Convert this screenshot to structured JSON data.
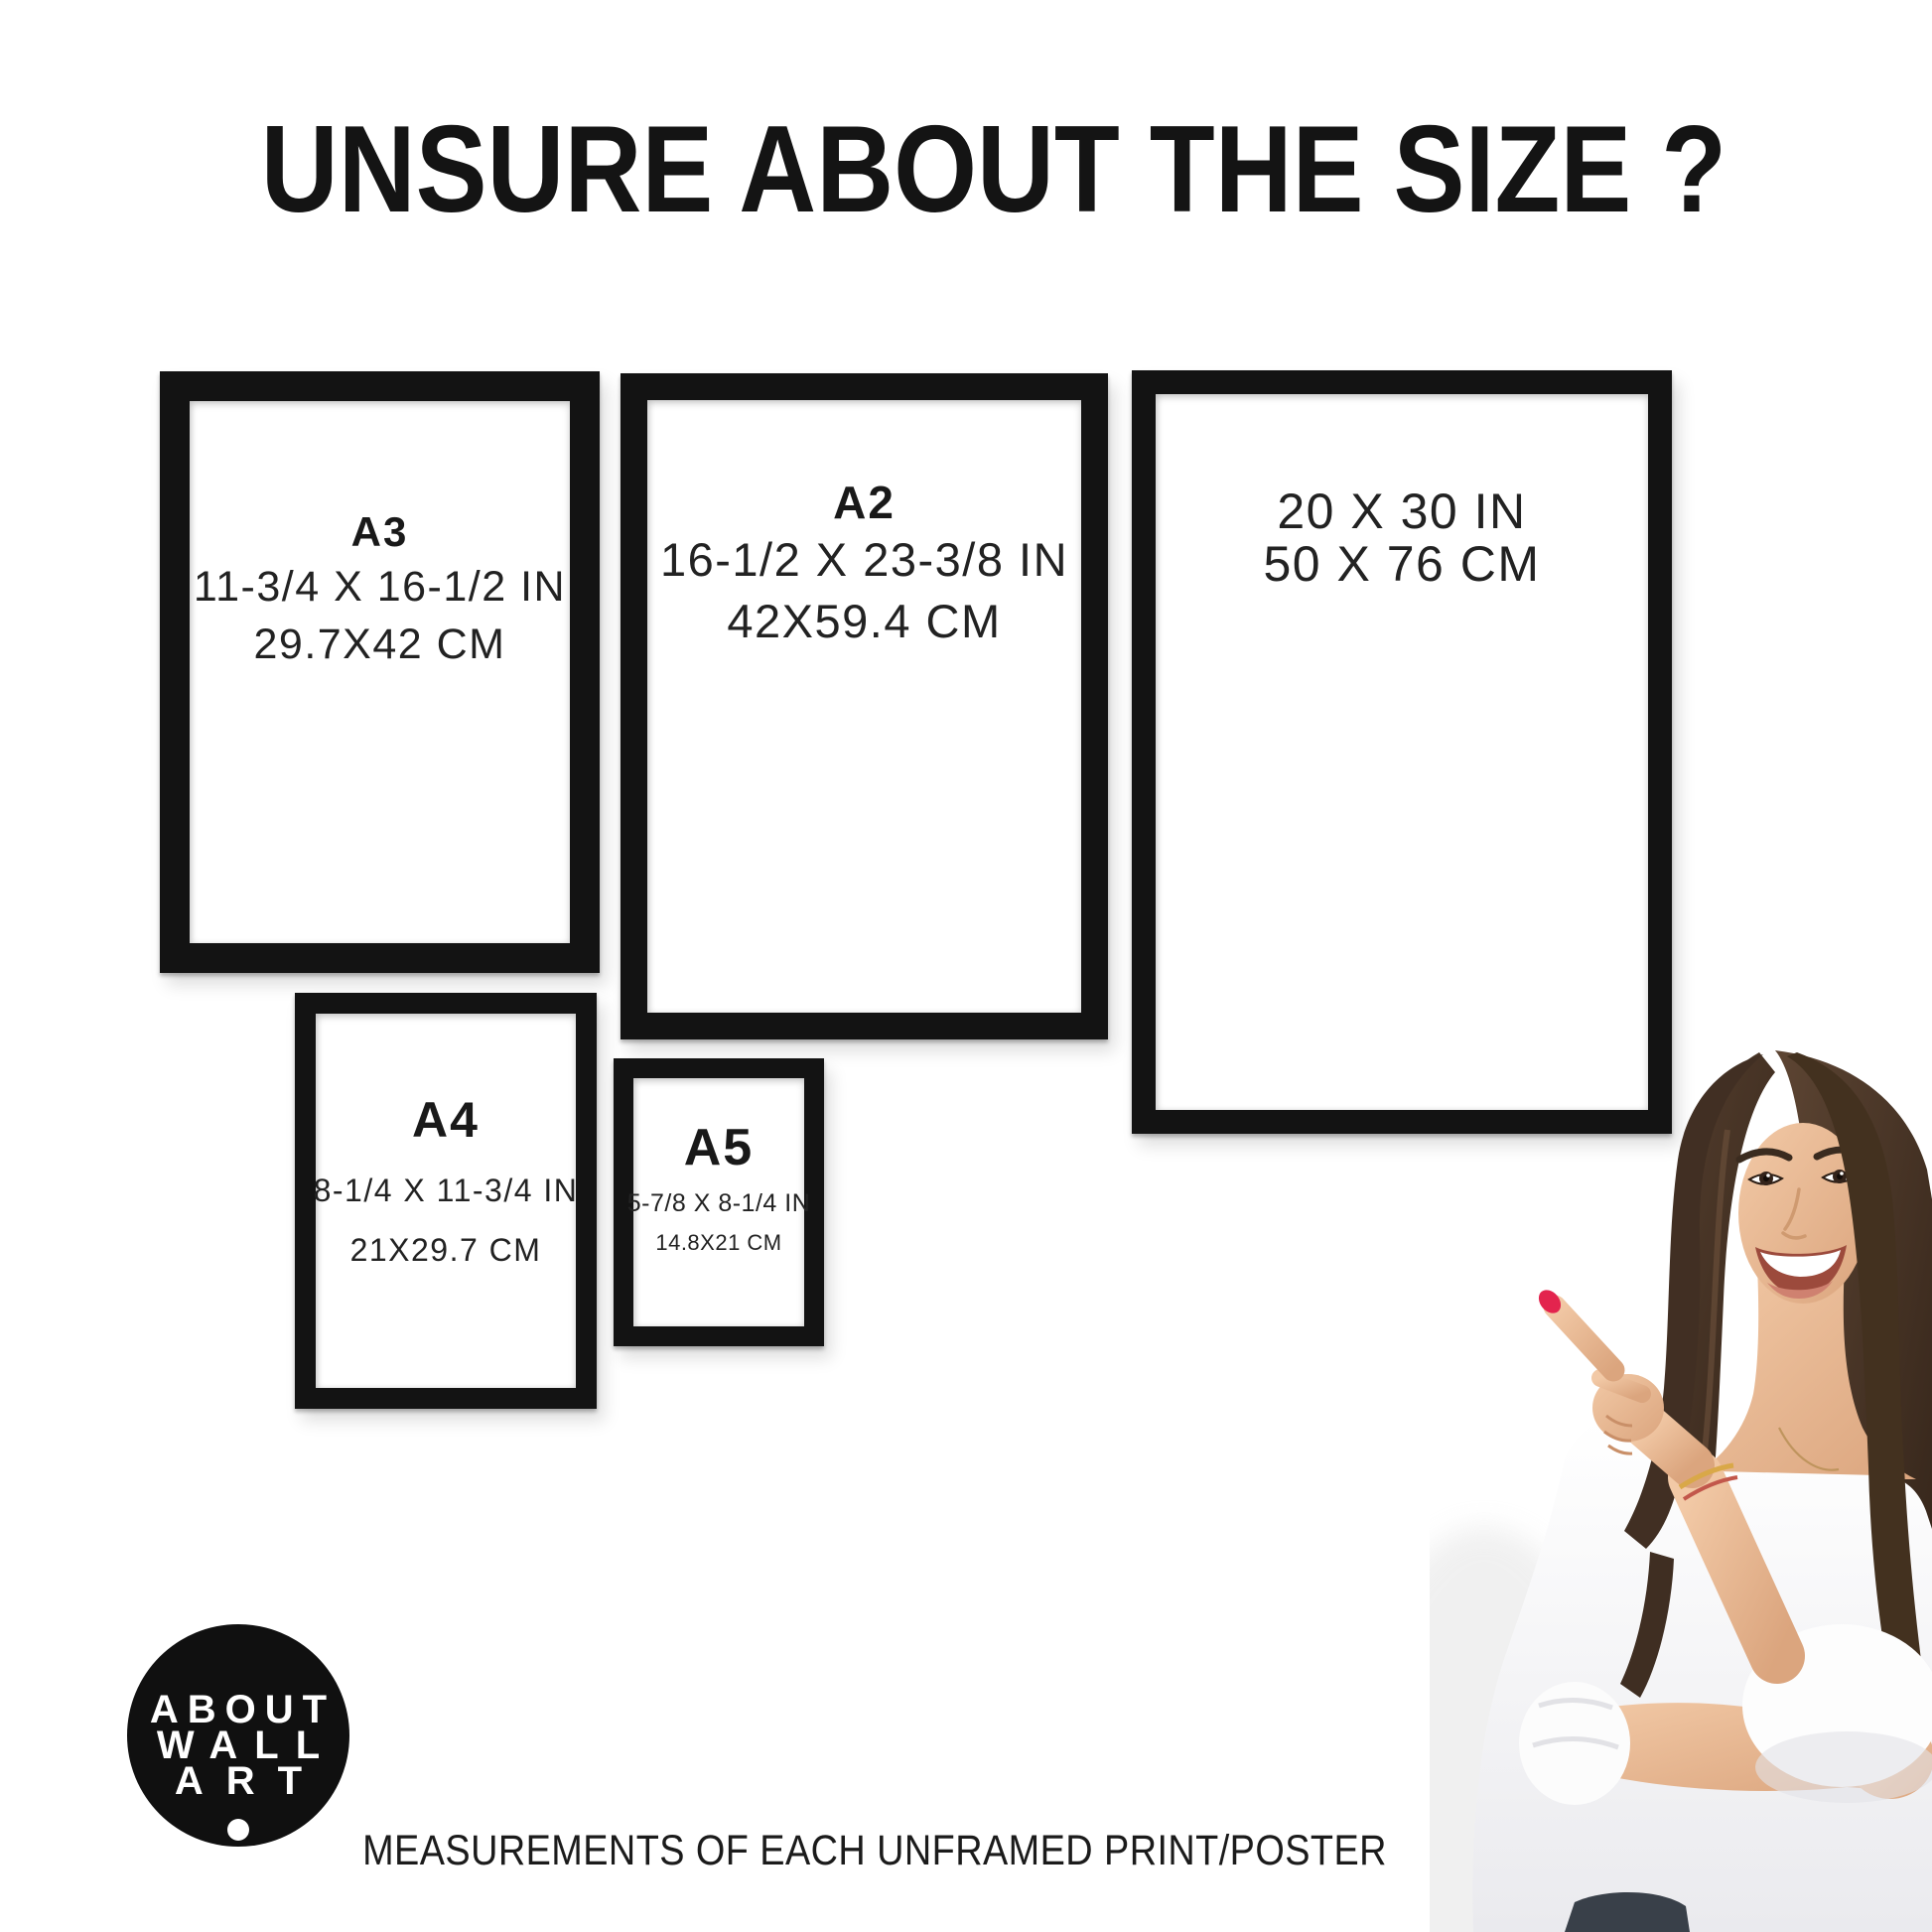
{
  "title": "UNSURE ABOUT THE SIZE ?",
  "caption": "MEASUREMENTS OF EACH UNFRAMED PRINT/POSTER",
  "frames": [
    {
      "id": "a3",
      "label": "A3",
      "inches": "11-3/4 X 16-1/2 IN",
      "cm": "29.7X42 CM"
    },
    {
      "id": "a2",
      "label": "A2",
      "inches": "16-1/2 X 23-3/8 IN",
      "cm": "42X59.4 CM"
    },
    {
      "id": "20x30",
      "label": "",
      "inches": "20 X 30 IN",
      "cm": "50 X 76 CM"
    },
    {
      "id": "a4",
      "label": "A4",
      "inches": "8-1/4 X 11-3/4 IN",
      "cm": "21X29.7 CM"
    },
    {
      "id": "a5",
      "label": "A5",
      "inches": "5-7/8 X 8-1/4 IN",
      "cm": "14.8X21 CM"
    }
  ],
  "logo": {
    "line1": "ABOUT",
    "line2": "WALL",
    "line3": "ART"
  },
  "colors": {
    "frame_black": "#131313",
    "text_black": "#1c1c1c",
    "logo_background": "#101010",
    "nail_red": "#e3244e",
    "hair_brown": "#43301f",
    "skin_tan": "#ecbd9c",
    "blouse_white": "#f8f7f6",
    "jeans_dark": "#394049",
    "bracelet_gold": "#d9a848"
  }
}
